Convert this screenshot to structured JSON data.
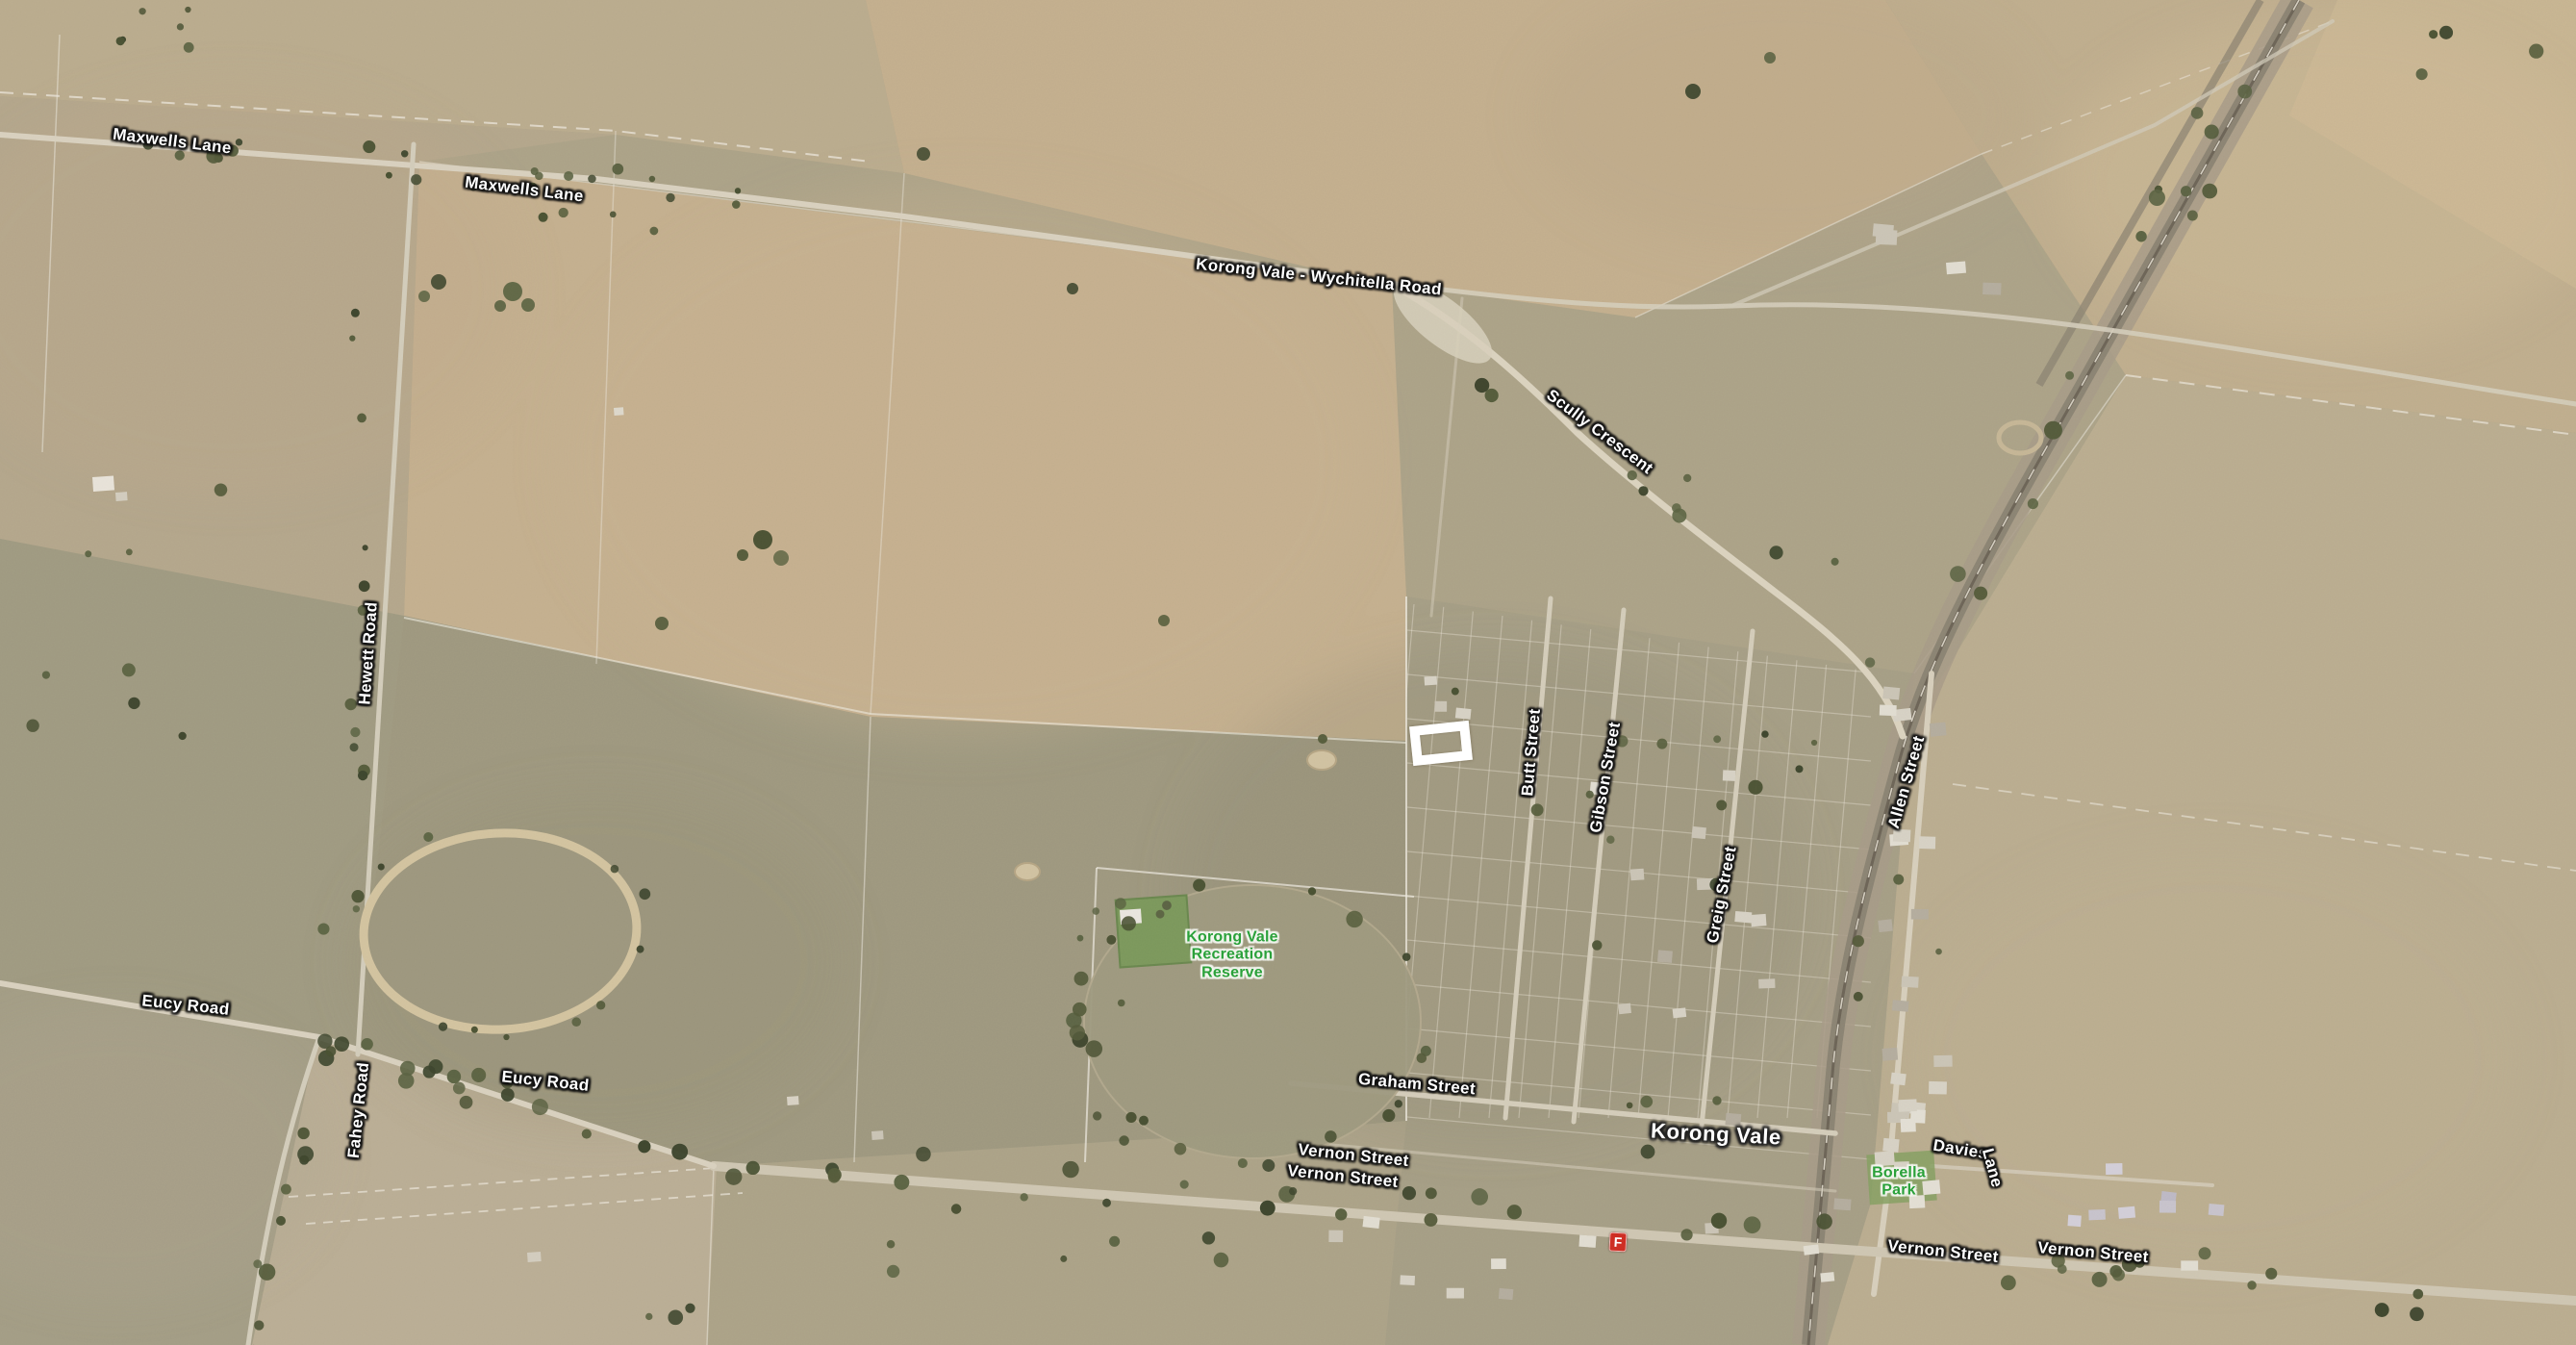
{
  "map": {
    "locality": "Korong Vale"
  },
  "labels": {
    "maxwells_lane_1": "Maxwells Lane",
    "maxwells_lane_2": "Maxwells Lane",
    "wychitella_road": "Korong Vale - Wychitella Road",
    "scully_crescent": "Scully Crescent",
    "hewett_road": "Hewett Road",
    "butt_street": "Butt Street",
    "gibson_street": "Gibson Street",
    "greig_street": "Greig Street",
    "allen_street": "Allen Street",
    "eucy_road_1": "Eucy Road",
    "eucy_road_2": "Eucy Road",
    "fahey_road": "Fahey Road",
    "graham_street": "Graham Street",
    "vernon_street_1": "Vernon Street",
    "vernon_street_2": "Vernon Street",
    "vernon_street_3": "Vernon Street",
    "vernon_street_4": "Vernon Street",
    "davies": "Davies",
    "davies_lane_part": "Lane",
    "korong_vale_locality": "Korong Vale"
  },
  "parks": {
    "recreation_reserve": {
      "line1": "Korong Vale",
      "line2": "Recreation",
      "line3": "Reserve"
    },
    "borella_park": {
      "line1": "Borella",
      "line2": "Park"
    }
  },
  "markers": {
    "fuel_label": "F"
  },
  "colors": {
    "road_label_text": "#ffffff",
    "park_label_text": "#2aa13a",
    "fuel_marker_bg": "#ce2f24",
    "selection_outline": "#ffffff"
  }
}
